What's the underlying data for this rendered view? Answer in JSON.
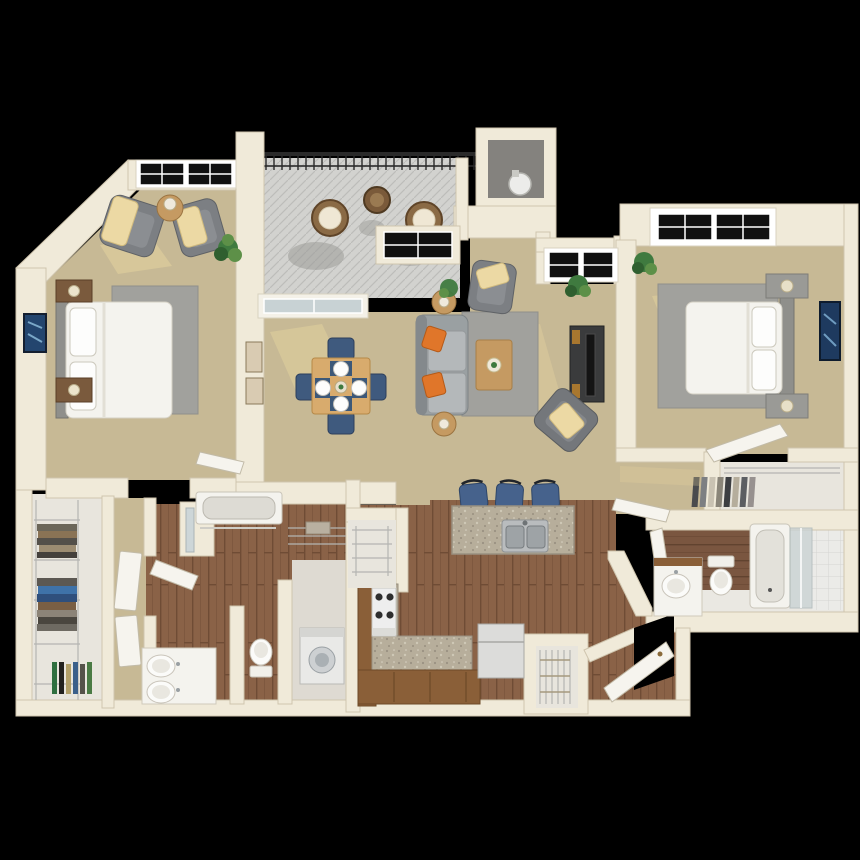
{
  "title": "3D floor plan of a two bedroom, two bathroom apartment with balcony",
  "palette": {
    "bg": "#000000",
    "wall": "#f0ead9",
    "wallEdge": "#cfc5ae",
    "carpet": "#c7b995",
    "sun": "#ecd9a0",
    "rug": "#a1a19d",
    "wood": "#8a6247",
    "woodLine": "#6f4c35",
    "balcony": "#d2d2cf",
    "concrete": "#84827e",
    "railing": "#2a2a2a",
    "white": "#f4f3ee",
    "appliance": "#e8e8e6",
    "steel": "#b9bcbe",
    "sofa": "#9aa0a2",
    "chair": "#7c7f83",
    "orange": "#e0762a",
    "throw": "#ecd9a4",
    "navy": "#3f5a7e",
    "stool": "#46628c",
    "tableWood": "#d8ab6d",
    "sideWood": "#c59a62",
    "nightWood": "#7a5a3d",
    "console": "#3a3b3c",
    "granite": "#b7ae9b",
    "counterWood": "#8a5f38",
    "glass": "#c8d2d4",
    "windowDark": "#101010",
    "plant": "#3f7a3f",
    "artBlue": "#23456e",
    "closetFloor": "#e8e5dd",
    "wire": "#b5b5b2"
  },
  "rooms": {
    "bedroom1": "Bedroom 1",
    "bedroom2": "Bedroom 2",
    "living": "Living Room",
    "dining": "Dining Area",
    "kitchen": "Kitchen",
    "balcony": "Balcony",
    "storage": "Storage closet with water heater",
    "bathroom1": "Bathroom 1 with double vanity and tub",
    "bathroom2": "Bathroom 2 with tub and shower",
    "laundry": "Laundry closet with washer dryer",
    "walkInCloset": "Walk-in closet with wire shelving",
    "dressingHall": "Dressing hallway",
    "bedroom2Closet": "Bedroom 2 closet",
    "kitchenPantry": "Kitchen pantry",
    "entryPantry": "Entry pantry",
    "hall": "Hallway",
    "entry": "Entry with front door"
  }
}
